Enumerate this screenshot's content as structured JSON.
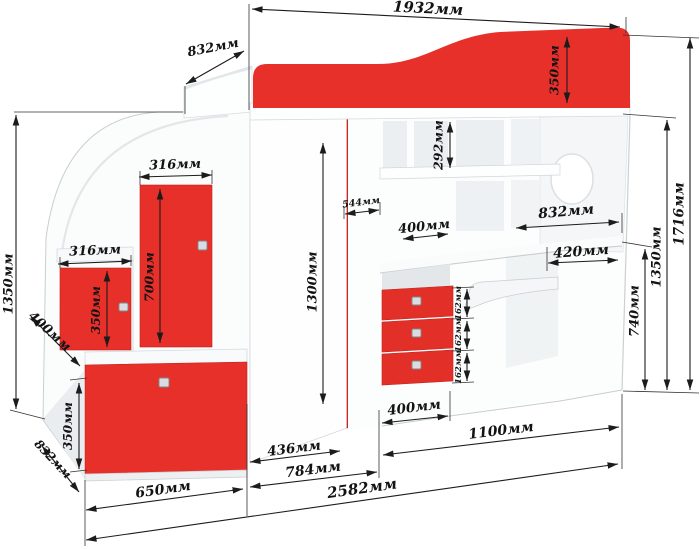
{
  "colors": {
    "furniture_red": "#e7302a",
    "wardrobe_door_red": "#da2722",
    "drawer_red": "#e23029",
    "dimension_line": "#1c1c1c",
    "panel_white": "#fcfdfd",
    "panel_edge": "#c9ced2"
  },
  "dims": {
    "top": {
      "overall_width": "1932мм",
      "platform_depth": "832мм"
    },
    "bed": {
      "headboard_height": "350мм"
    },
    "right": {
      "overall_height": "1716мм",
      "underbed_height": "1350мм",
      "desk_height": "740мм"
    },
    "hutch": {
      "niche_height": "292мм",
      "niche_width": "400мм"
    },
    "desk": {
      "top_width": "832мм",
      "corner_depth": "420мм"
    },
    "wardrobe": {
      "door_width": "544мм",
      "door_height": "1300мм"
    },
    "drawers": {
      "h1": "162мм",
      "h2": "162мм",
      "h3": "162мм",
      "unit_width": "400мм"
    },
    "stairs": {
      "upper_door_width": "316мм",
      "upper_door_height": "700мм",
      "lower_door_width": "316мм",
      "lower_door_height": "350мм",
      "step_depth": "400мм",
      "height": "1350мм",
      "drawer_height": "350мм",
      "drawer_depth": "832мм",
      "step_width": "650мм"
    },
    "bottom": {
      "wardrobe_depth": "436мм",
      "wardrobe_full_depth": "784мм",
      "desk_span": "1100мм",
      "overall_length": "2582мм"
    }
  }
}
